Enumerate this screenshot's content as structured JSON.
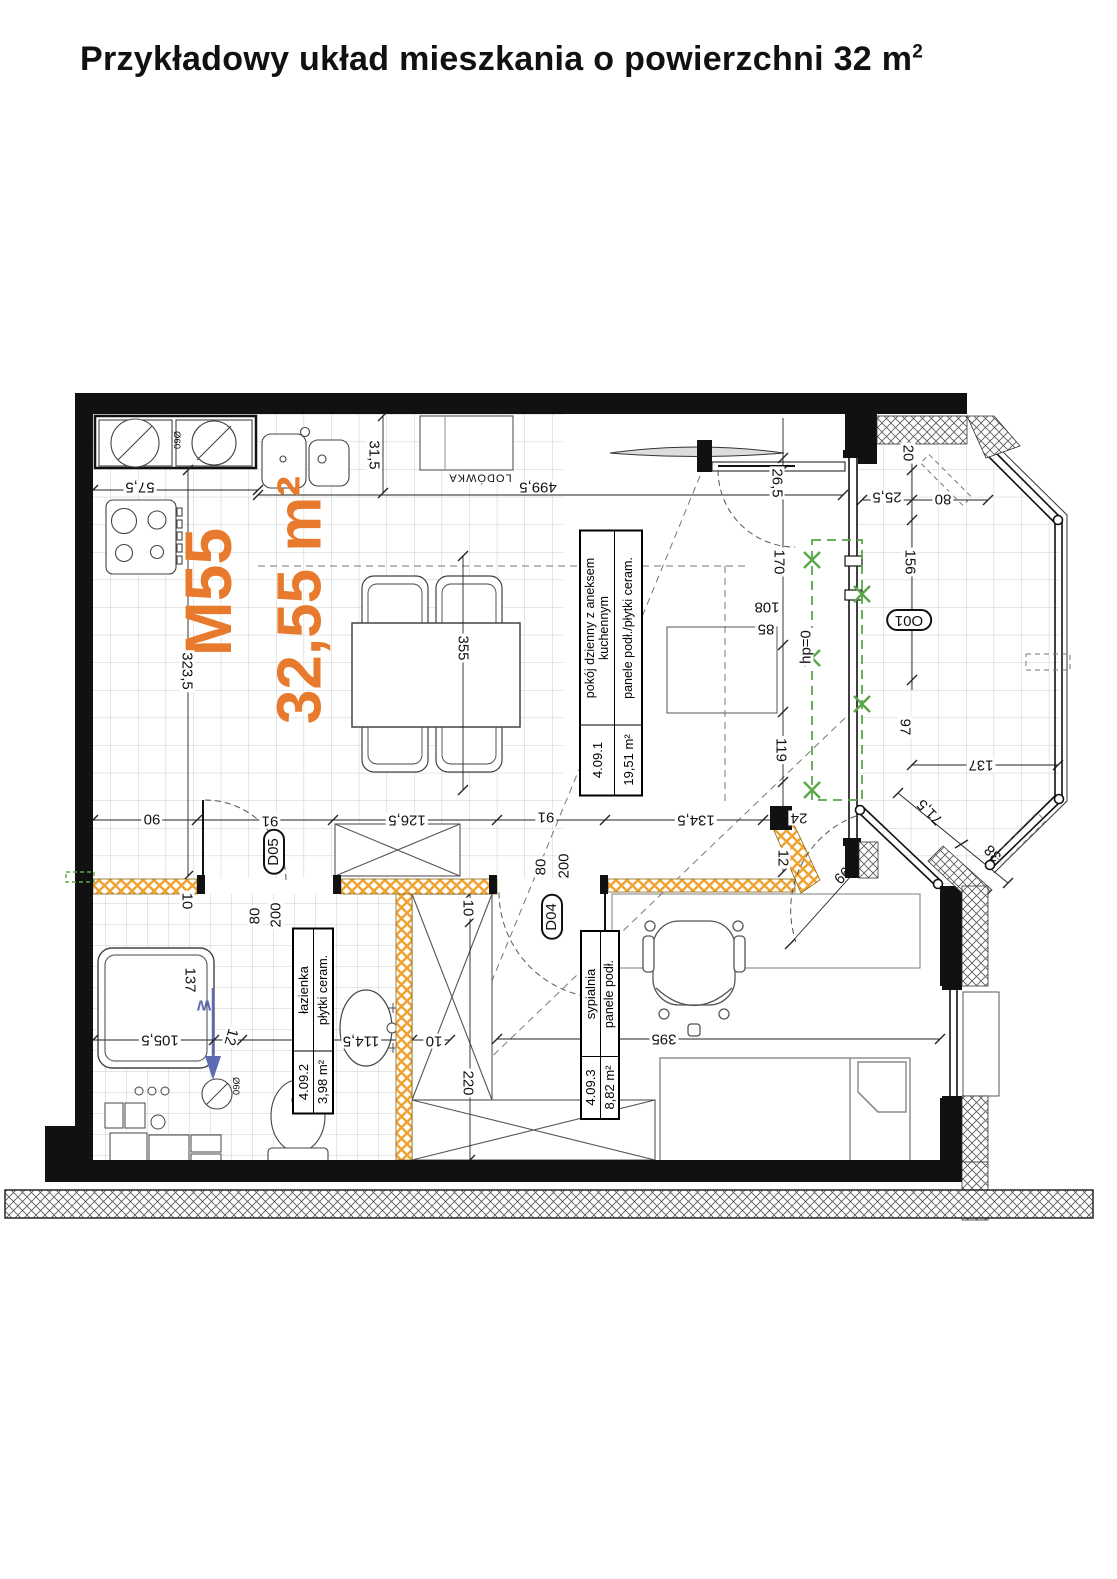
{
  "title": {
    "text": "Przykładowy układ mieszkania o powierzchni 32 m",
    "sup": "2"
  },
  "unit": {
    "code": "M55",
    "area": "32,55 m²"
  },
  "rooms": {
    "living": {
      "name1": "pokój dzienny z aneksem",
      "name2": "kuchennym",
      "finish": "panele podł./płytki ceram.",
      "code": "4.09.1",
      "area": "19,51 m²"
    },
    "bathroom": {
      "name": "łazienka",
      "finish": "płytki ceram.",
      "code": "4.09.2",
      "area": "3,98 m²"
    },
    "bedroom": {
      "name": "sypialnia",
      "finish": "panele podł.",
      "code": "4.09.3",
      "area": "8,82 m²"
    }
  },
  "labels": {
    "fridge": "LODÓWKA",
    "window_o01": "O01",
    "door_d04": "D04",
    "door_d05": "D05",
    "parapet": "hp=0",
    "vent": "W",
    "door_width": "80",
    "door_height": "200",
    "diameter": "Ø60"
  },
  "dims": {
    "k31_5": "31,5",
    "k57_5": "57,5",
    "k323_5": "323,5",
    "k499_5": "499,5",
    "k355": "355",
    "k26_5": "26,5",
    "k170": "170",
    "k108": "108",
    "k85": "85",
    "k119": "119",
    "k24": "24",
    "k12_hall": "12",
    "k20": "20",
    "k25_5": "25,5",
    "k80_bal": "80",
    "k156": "156",
    "k97": "97",
    "k137_bal": "137",
    "k71_5": "71,5",
    "k38": "38",
    "k99": "99",
    "k90": "90",
    "k91_l": "91",
    "k126_5": "126,5",
    "k91_r": "91",
    "k134_5": "134,5",
    "k10_l": "10",
    "k10_ward": "10",
    "k10_mid": "10",
    "k220": "220",
    "k395": "395",
    "k137_shower": "137",
    "k105_5": "105,5",
    "k12_bath": "12",
    "k114_5": "114,5"
  },
  "colors": {
    "accent_orange": "#e87a2e",
    "wall_black": "#111111",
    "hatch_yellow": "#f0a22e",
    "opening_green": "#58a847",
    "vent_blue": "#5f6bb0",
    "tile_gray": "#cccccc"
  }
}
